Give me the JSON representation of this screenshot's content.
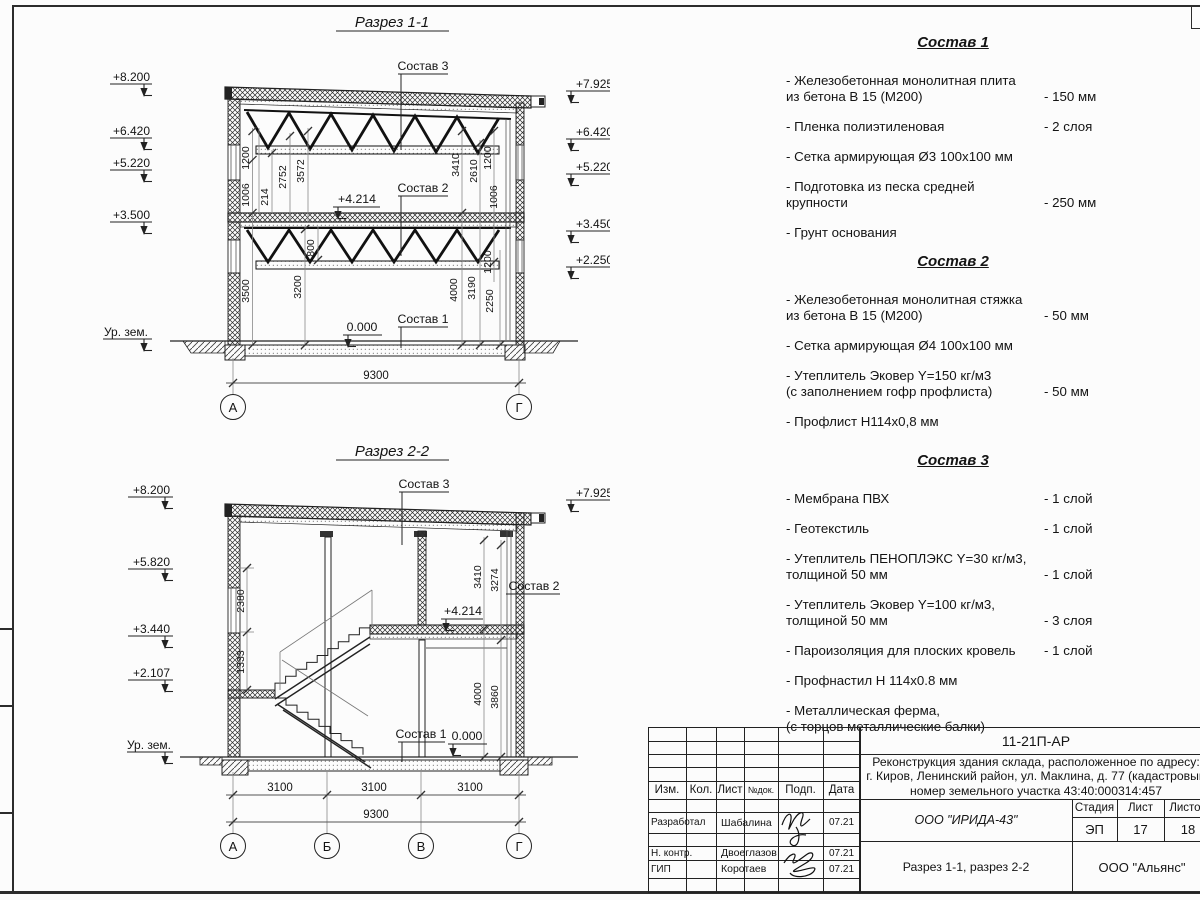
{
  "s1": {
    "title": "Разрез 1-1",
    "elev_left": [
      "+8.200",
      "+6.420",
      "+5.220",
      "+3.500"
    ],
    "ground": "Ур. зем.",
    "elev_right": [
      "+7.925",
      "+6.420",
      "+5.220",
      "+3.450",
      "+2.250"
    ],
    "sostav3": "Состав 3",
    "sostav2": "Состав 2",
    "sostav1": "Состав 1",
    "lvl_mid": "+4.214",
    "lvl_zero": "0.000",
    "d": {
      "d1006a": "1006",
      "d1200a": "1200",
      "d214": "214",
      "d2752": "2752",
      "d3572": "3572",
      "d3410": "3410",
      "d2610": "2610",
      "d1200b": "1200",
      "d1006b": "1006",
      "d3500": "3500",
      "d3200": "3200",
      "d800": "800",
      "d4000": "4000",
      "d3190": "3190",
      "d2250": "2250",
      "d1200c": "1200"
    },
    "total": "9300",
    "axis_a": "А",
    "axis_g": "Г"
  },
  "s2": {
    "title": "Разрез 2-2",
    "elev_left": [
      "+8.200",
      "+5.820",
      "+3.440",
      "+2.107"
    ],
    "ground": "Ур. зем.",
    "elev_right": [
      "+7.925"
    ],
    "sostav3": "Состав 3",
    "sostav2": "Состав 2",
    "sostav1": "Состав 1",
    "lvl_mid": "+4.214",
    "lvl_zero": "0.000",
    "d": {
      "d2380": "2380",
      "d1333": "1333",
      "d3410": "3410",
      "d3274": "3274",
      "d4000": "4000",
      "d3860": "3860"
    },
    "spans": [
      "3100",
      "3100",
      "3100"
    ],
    "total": "9300",
    "axes": [
      "А",
      "Б",
      "В",
      "Г"
    ]
  },
  "lists": {
    "s1": {
      "title": "Состав 1",
      "items": [
        {
          "t": "- Железобетонная  монолитная плита\n  из бетона В 15 (М200)",
          "v": "- 150 мм"
        },
        {
          "t": "- Пленка полиэтиленовая",
          "v": "-  2 слоя"
        },
        {
          "t": "- Сетка армирующая Ø3 100х100 мм",
          "v": ""
        },
        {
          "t": "- Подготовка из песка средней\n  крупности",
          "v": "- 250 мм"
        },
        {
          "t": "- Грунт основания",
          "v": ""
        }
      ]
    },
    "s2": {
      "title": "Состав 2",
      "items": [
        {
          "t": "- Железобетонная  монолитная стяжка\n  из бетона В 15 (М200)",
          "v": "- 50 мм"
        },
        {
          "t": "- Сетка армирующая Ø4 100х100 мм",
          "v": ""
        },
        {
          "t": "- Утеплитель Эковер Y=150 кг/м3\n  (с заполнением гофр профлиста)",
          "v": "- 50 мм"
        },
        {
          "t": "- Профлист Н114х0,8 мм",
          "v": ""
        }
      ]
    },
    "s3": {
      "title": "Состав 3",
      "items": [
        {
          "t": "- Мембрана ПВХ",
          "v": "- 1 слой"
        },
        {
          "t": "- Геотекстиль",
          "v": "- 1 слой"
        },
        {
          "t": "- Утеплитель ПЕНОПЛЭКС Y=30 кг/м3,\n  толщиной 50 мм",
          "v": "- 1 слой"
        },
        {
          "t": "- Утеплитель Эковер Y=100 кг/м3,\n  толщиной 50 мм",
          "v": "- 3 слоя"
        },
        {
          "t": "- Пароизоляция для плоских кровель",
          "v": "- 1 слой"
        },
        {
          "t": "- Профнастил Н 114х0.8 мм",
          "v": ""
        },
        {
          "t": "- Металлическая ферма,\n  (с торцов металлические балки)",
          "v": ""
        }
      ]
    }
  },
  "tb": {
    "code": "11-21П-АР",
    "proj1": "Реконструкция здания склада, расположенное по адресу:",
    "proj2": "г. Киров, Ленинский район, ул. Маклина, д. 77 (кадастровый",
    "proj3": "номер земельного участка 43:40:000314:457",
    "org": "ООО \"ИРИДА-43\"",
    "drawing": "Разрез 1-1, разрез 2-2",
    "firm": "ООО \"Альянс\"",
    "h_izm": "Изм.",
    "h_kol": "Кол.",
    "h_list": "Лист",
    "h_ndok": "№док.",
    "h_podp": "Подп.",
    "h_data": "Дата",
    "h_stage": "Стадия",
    "h_sheet": "Лист",
    "h_sheets": "Листов",
    "stage": "ЭП",
    "sheet": "17",
    "sheets": "18",
    "r1": "Разработал",
    "n1": "Шабалина",
    "d1": "07.21",
    "r2": "Н. контр.",
    "n2": "Двоеглазов",
    "d2": "07.21",
    "r3": "ГИП",
    "n3": "Коротаев",
    "d3": "07.21"
  },
  "colors": {
    "line": "#222222",
    "thin": "#777777",
    "text": "#141414"
  }
}
